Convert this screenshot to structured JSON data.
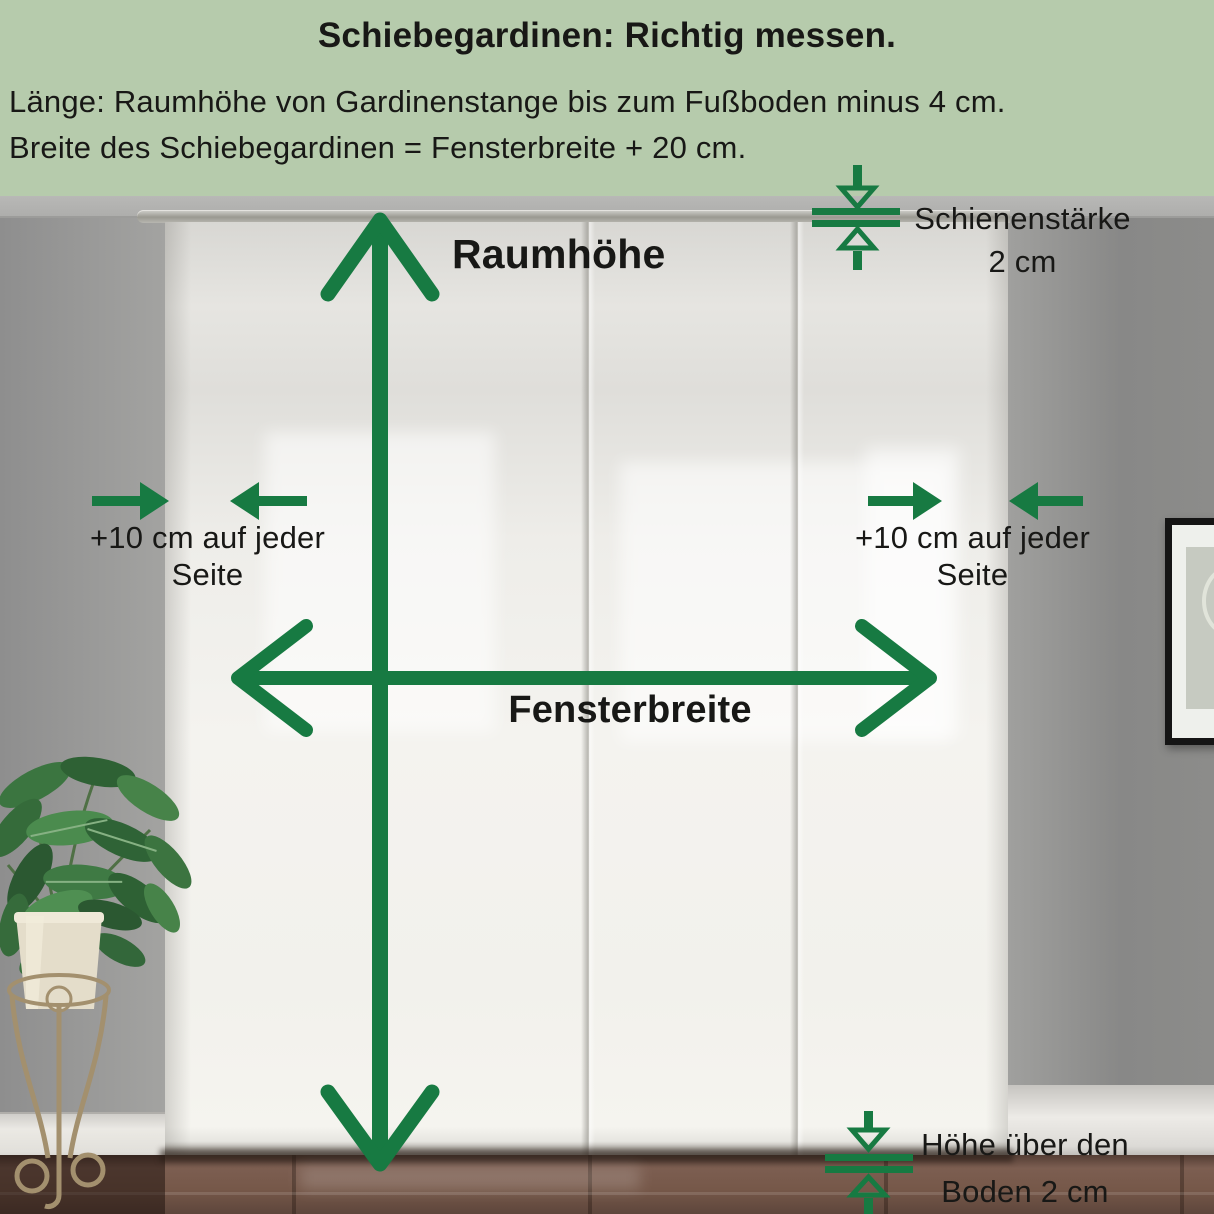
{
  "header": {
    "title": "Schiebegardinen: Richtig messen.",
    "line1": "Länge: Raumhöhe von Gardinenstange bis zum Fußboden minus 4 cm.",
    "line2": "Breite des Schiebegardinen = Fensterbreite + 20 cm."
  },
  "labels": {
    "room_height": "Raumhöhe",
    "window_width": "Fensterbreite",
    "left_offset": {
      "line1": "+10 cm auf jeder",
      "line2": "Seite"
    },
    "right_offset": {
      "line1": "+10 cm auf jeder",
      "line2": "Seite"
    },
    "rail": {
      "line1": "Schienenstärke",
      "line2": "2 cm"
    },
    "floor": {
      "line1": "Höhe über den",
      "line2": "Boden 2 cm"
    }
  },
  "colors": {
    "band_green": "#b6cbac",
    "arrow_green": "#177a42",
    "text_dark": "#181816"
  }
}
